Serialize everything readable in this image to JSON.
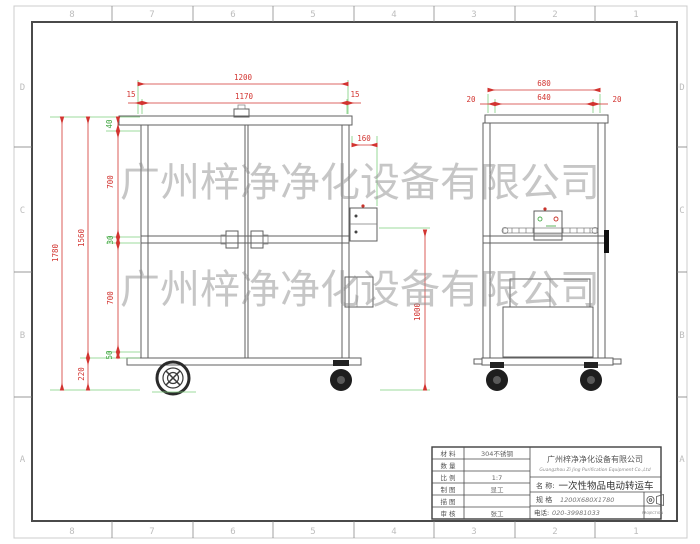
{
  "sheet": {
    "zones_top": [
      "8",
      "7",
      "6",
      "5",
      "4",
      "3",
      "2",
      "1"
    ],
    "zones_bottom": [
      "8",
      "7",
      "6",
      "5",
      "4",
      "3",
      "2",
      "1"
    ],
    "zones_left": [
      "D",
      "C",
      "B",
      "A"
    ],
    "zones_right": [
      "D",
      "C",
      "B",
      "A"
    ]
  },
  "watermark": {
    "line1": "广州梓净净化设备有限公司",
    "line2": "广州梓净净化设备有限公司"
  },
  "front_view": {
    "dims": {
      "overall_width": "1200",
      "inner_width": "1170",
      "wall_left": "15",
      "wall_right": "15",
      "lid": "40",
      "upper": "700",
      "mid_rail": "30",
      "lower": "700",
      "bottom_rail": "50",
      "body_height": "1560",
      "overall_height": "1780",
      "wheel_height": "220",
      "handle_offset": "160",
      "handle_height": "1000"
    }
  },
  "side_view": {
    "dims": {
      "overall_depth": "680",
      "inner_depth": "640",
      "wall_left": "20",
      "wall_right": "20"
    }
  },
  "title_block": {
    "rows": [
      {
        "label": "材 料",
        "value": "304不锈钢"
      },
      {
        "label": "数 量",
        "value": ""
      },
      {
        "label": "比 例",
        "value": "1:7"
      },
      {
        "label": "制 图",
        "value": "显工"
      },
      {
        "label": "描 图",
        "value": ""
      },
      {
        "label": "审 核",
        "value": "张工"
      }
    ],
    "company_cn": "广州梓净净化设备有限公司",
    "company_en": "Guangzhou Zi Jing Purification Equipment Co.,Ltd",
    "name_label": "名 称:",
    "name_value": "一次性物品电动转运车",
    "spec_label": "规 格",
    "spec_value": "1200X680X1780",
    "phone_label": "电话:",
    "phone_value": "020-39981033",
    "projection_label": "PROJECTION"
  }
}
